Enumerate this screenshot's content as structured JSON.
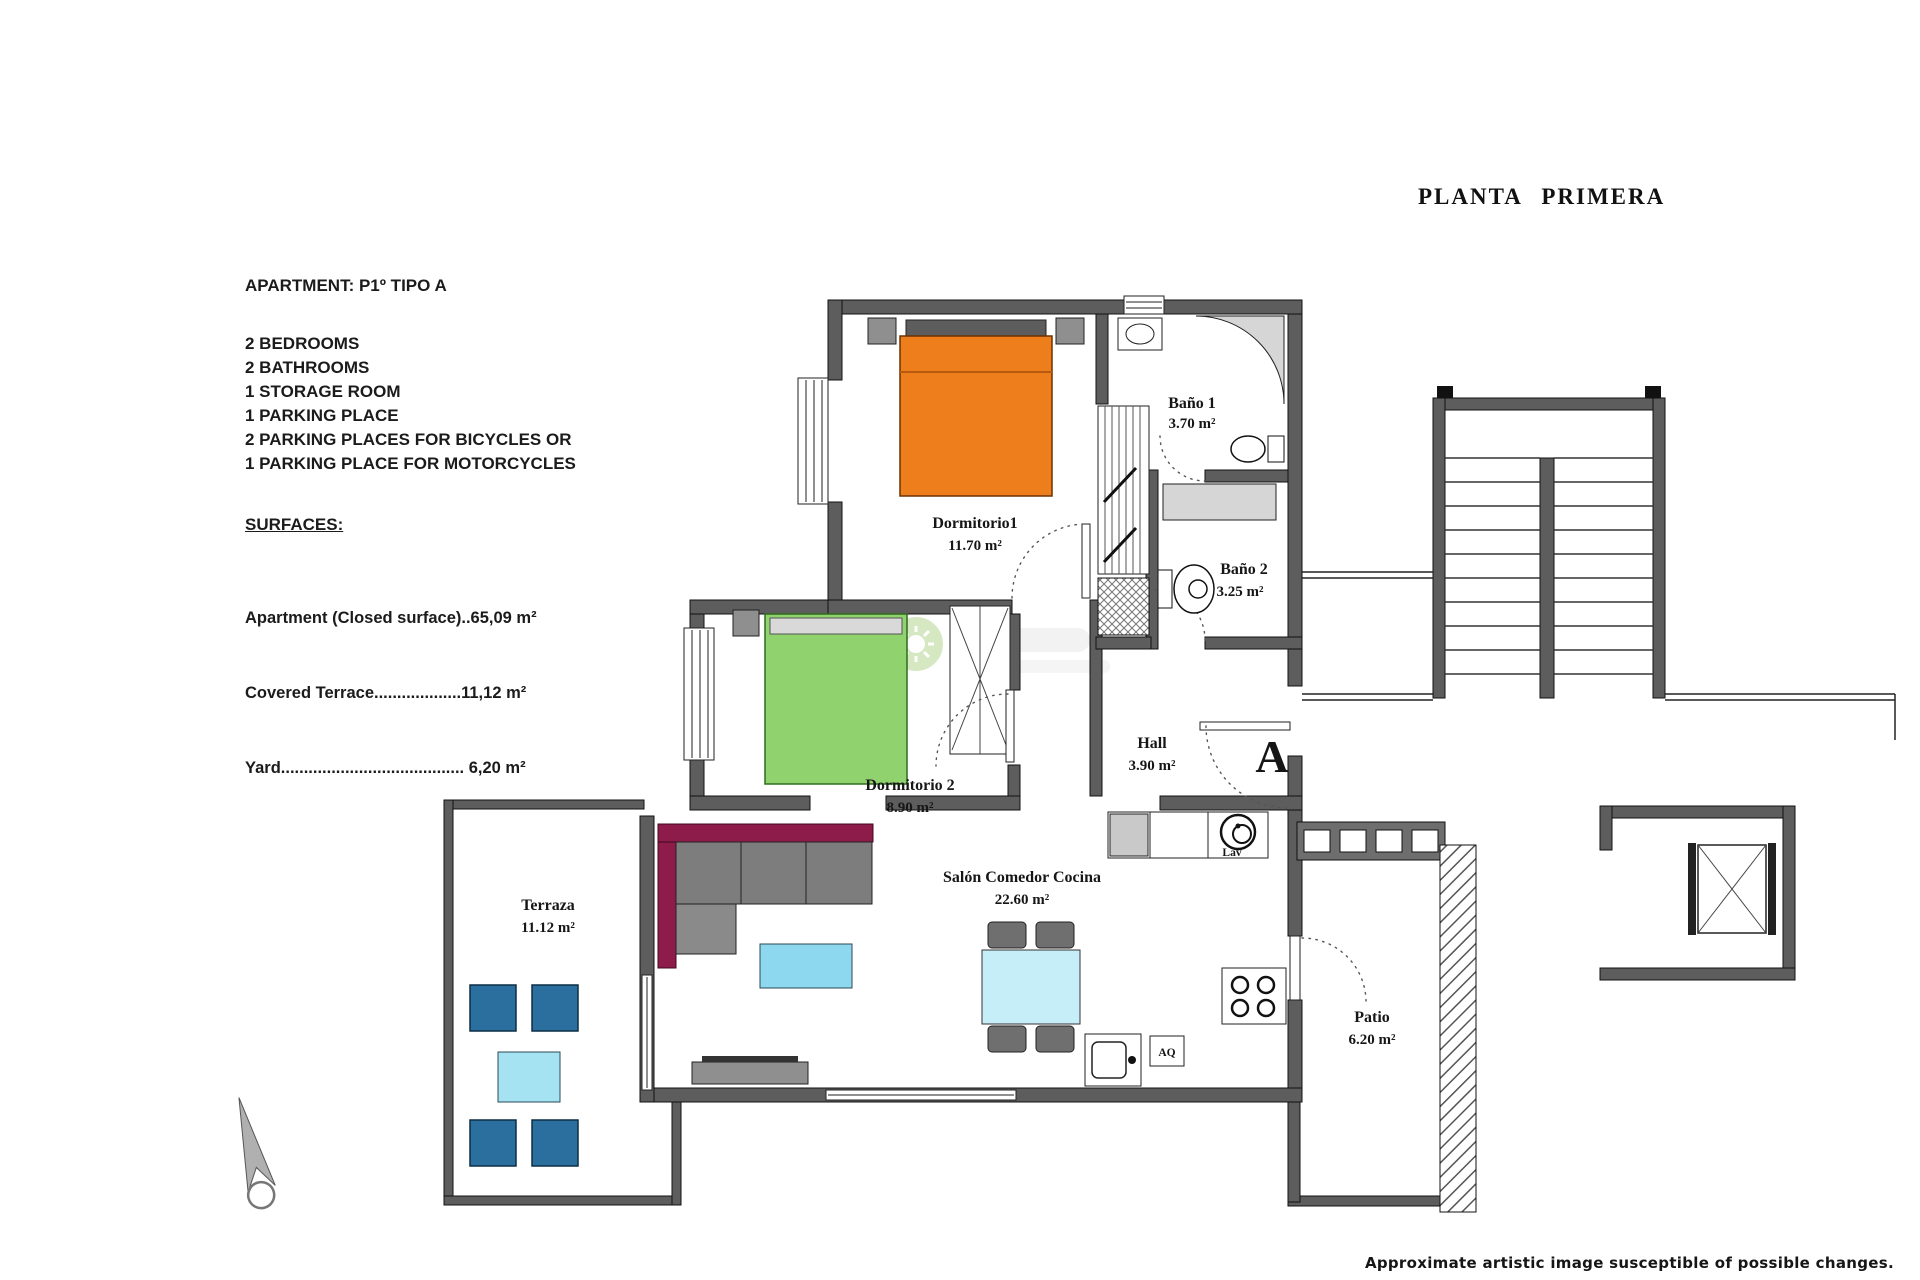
{
  "title": "PLANTA PRIMERA",
  "info": {
    "apartment": "APARTMENT: P1º TIPO A",
    "features": [
      "2 BEDROOMS",
      "2 BATHROOMS",
      "1 STORAGE ROOM",
      "1 PARKING PLACE",
      "2 PARKING PLACES FOR BICYCLES OR",
      "1 PARKING PLACE FOR MOTORCYCLES"
    ],
    "surfaces_heading": "SURFACES:",
    "surface_lines": [
      "Apartment (Closed surface)..65,09 m²",
      "Covered Terrace...................11,12 m²",
      "Yard........................................ 6,20 m²"
    ]
  },
  "rooms": {
    "bano1": {
      "name": "Baño 1",
      "area": "3.70 m²"
    },
    "dormitorio1": {
      "name": "Dormitorio1",
      "area": "11.70 m²"
    },
    "bano2": {
      "name": "Baño 2",
      "area": "3.25 m²"
    },
    "hall": {
      "name": "Hall",
      "area": "3.90 m²"
    },
    "dormitorio2": {
      "name": "Dormitorio 2",
      "area": "8.90 m²"
    },
    "salon": {
      "name": "Salón Comedor Cocina",
      "area": "22.60 m²"
    },
    "terraza": {
      "name": "Terraza",
      "area": "11.12 m²"
    },
    "patio": {
      "name": "Patio",
      "area": "6.20 m²"
    }
  },
  "plan": {
    "entrance_letter": "A",
    "washer_label": "Lav",
    "water_heater_label": "AQ"
  },
  "icons": {
    "north_arrow": "compass-needle",
    "watermark": "green-sun-logo"
  },
  "colors": {
    "wall": "#5d5d5d",
    "bed_orange": "#ee7d1b",
    "bed_green": "#90d36e",
    "sofa_maroon": "#8e1c4a",
    "sofa_gray": "#7d7d7d",
    "coffee_table": "#8ed8ef",
    "dining_table": "#c6eef8",
    "terrace_chair": "#2a6f9e",
    "terrace_table": "#a5e2f2",
    "fixture_gray": "#d6d6d6"
  },
  "disclaimer": "Approximate artistic image susceptible of possible changes."
}
